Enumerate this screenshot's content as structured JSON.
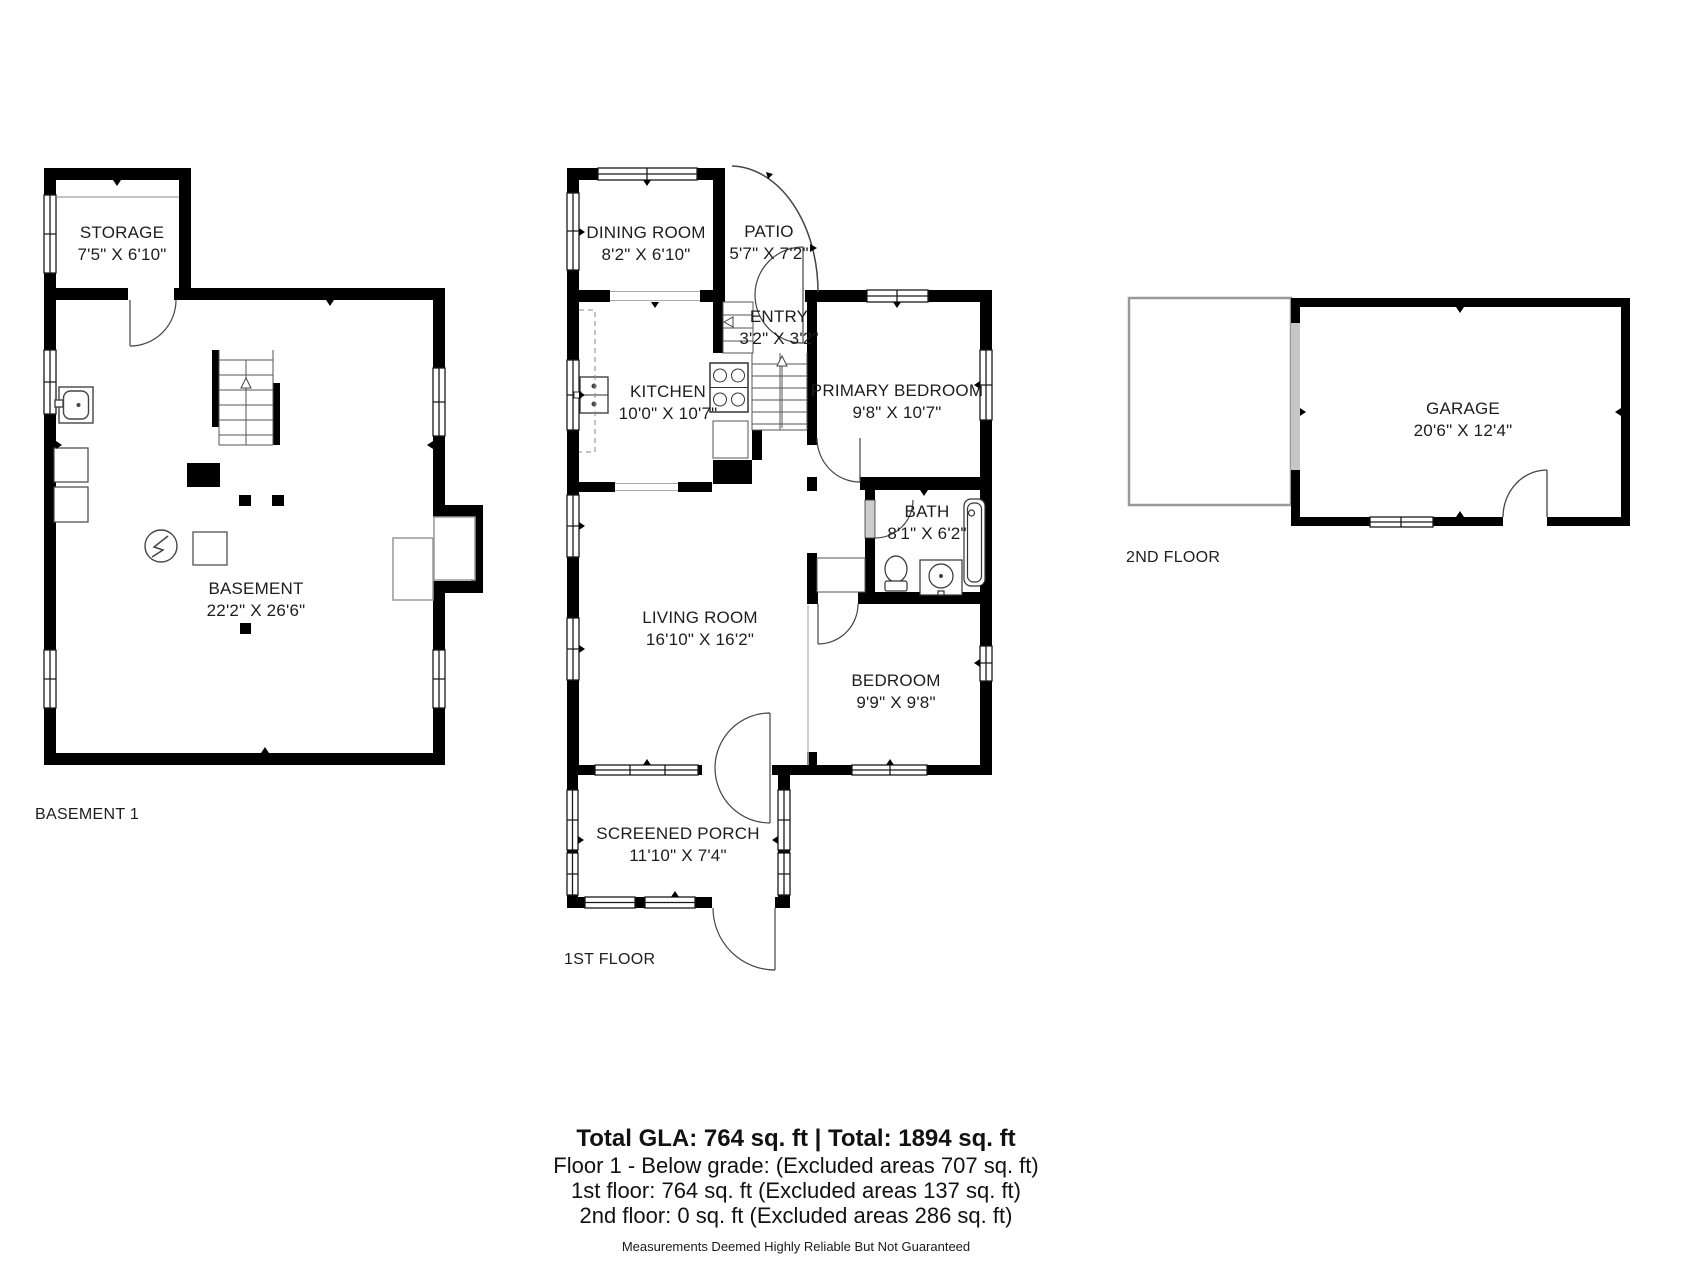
{
  "colors": {
    "wall": "#000000",
    "thin_line": "#444444",
    "text": "#1d1d1d"
  },
  "floors": {
    "basement": {
      "label": "BASEMENT 1",
      "rooms": {
        "storage": {
          "name": "STORAGE",
          "dims": "7'5\" X 6'10\""
        },
        "basement": {
          "name": "BASEMENT",
          "dims": "22'2\" X 26'6\""
        }
      }
    },
    "first": {
      "label": "1ST FLOOR",
      "rooms": {
        "dining": {
          "name": "DINING ROOM",
          "dims": "8'2\" X 6'10\""
        },
        "patio": {
          "name": "PATIO",
          "dims": "5'7\" X 7'2\""
        },
        "entry": {
          "name": "ENTRY",
          "dims": "3'2\" X 3'2\""
        },
        "kitchen": {
          "name": "KITCHEN",
          "dims": "10'0\" X 10'7\""
        },
        "primary": {
          "name": "PRIMARY BEDROOM",
          "dims": "9'8\" X 10'7\""
        },
        "bath": {
          "name": "BATH",
          "dims": "8'1\" X 6'2\""
        },
        "living": {
          "name": "LIVING ROOM",
          "dims": "16'10\" X 16'2\""
        },
        "bedroom": {
          "name": "BEDROOM",
          "dims": "9'9\" X 9'8\""
        },
        "porch": {
          "name": "SCREENED PORCH",
          "dims": "11'10\" X 7'4\""
        }
      }
    },
    "second": {
      "label": "2ND FLOOR",
      "rooms": {
        "garage": {
          "name": "GARAGE",
          "dims": "20'6\" X 12'4\""
        }
      }
    }
  },
  "summary": {
    "total": "Total GLA: 764 sq. ft | Total: 1894 sq. ft",
    "line1": "Floor 1 - Below grade: (Excluded areas 707 sq. ft)",
    "line2": "1st floor: 764 sq. ft (Excluded areas 137 sq. ft)",
    "line3": "2nd floor: 0 sq. ft (Excluded areas 286 sq. ft)",
    "disclaimer": "Measurements Deemed Highly Reliable But Not Guaranteed"
  }
}
